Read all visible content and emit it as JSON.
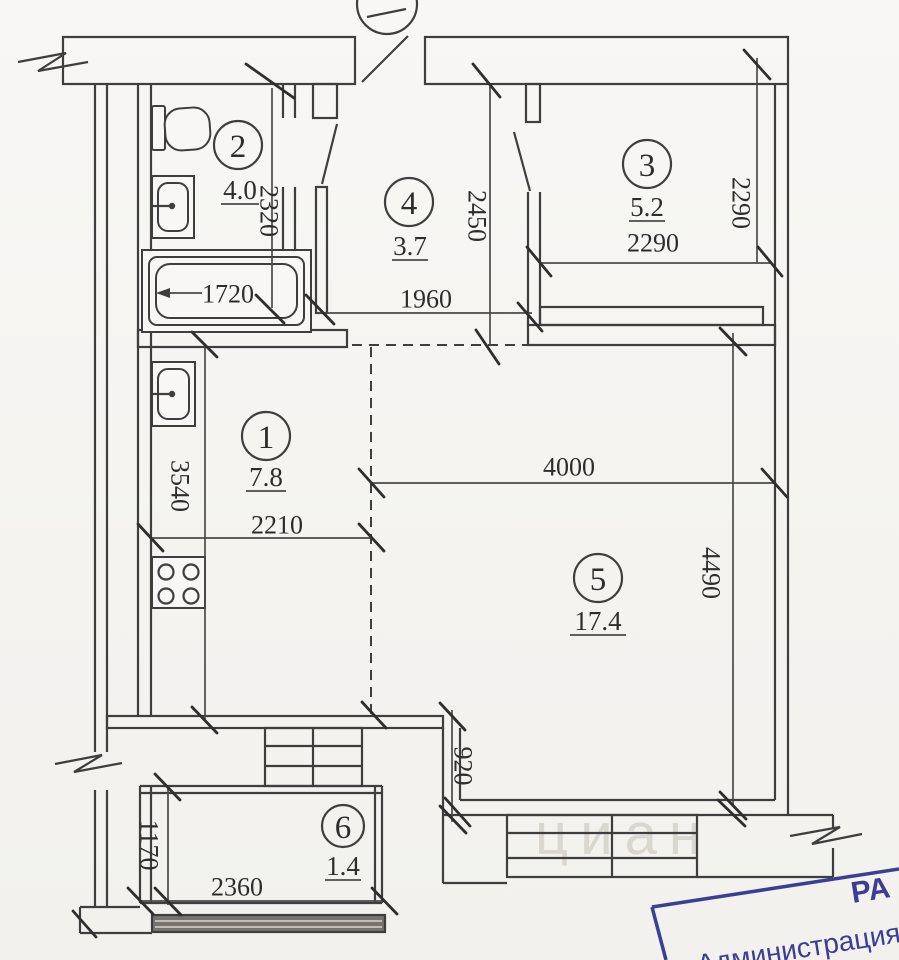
{
  "plan": {
    "rooms": [
      {
        "number": "1",
        "area": "7.8"
      },
      {
        "number": "2",
        "area": "4.0"
      },
      {
        "number": "3",
        "area": "5.2"
      },
      {
        "number": "4",
        "area": "3.7"
      },
      {
        "number": "5",
        "area": "17.4"
      },
      {
        "number": "6",
        "area": "1.4"
      }
    ],
    "dims": {
      "bath_height": "2320",
      "bathtub_length": "1720",
      "hall_height": "2450",
      "hall_width": "1960",
      "room3_width": "2290",
      "room3_height": "2290",
      "kitchen_height": "3540",
      "kitchen_width": "2210",
      "room5_width": "4000",
      "room5_height": "4490",
      "passage_width": "920",
      "balcony_height": "1170",
      "balcony_width": "2360"
    },
    "stamp": {
      "line1": "РА",
      "line2": "Администрация",
      "color": "#3c3e96"
    },
    "watermark": "циан",
    "colors": {
      "ink": "#3e3e3e",
      "paper": "#f5f4f1",
      "stamp_blue": "#3c3e96"
    }
  }
}
